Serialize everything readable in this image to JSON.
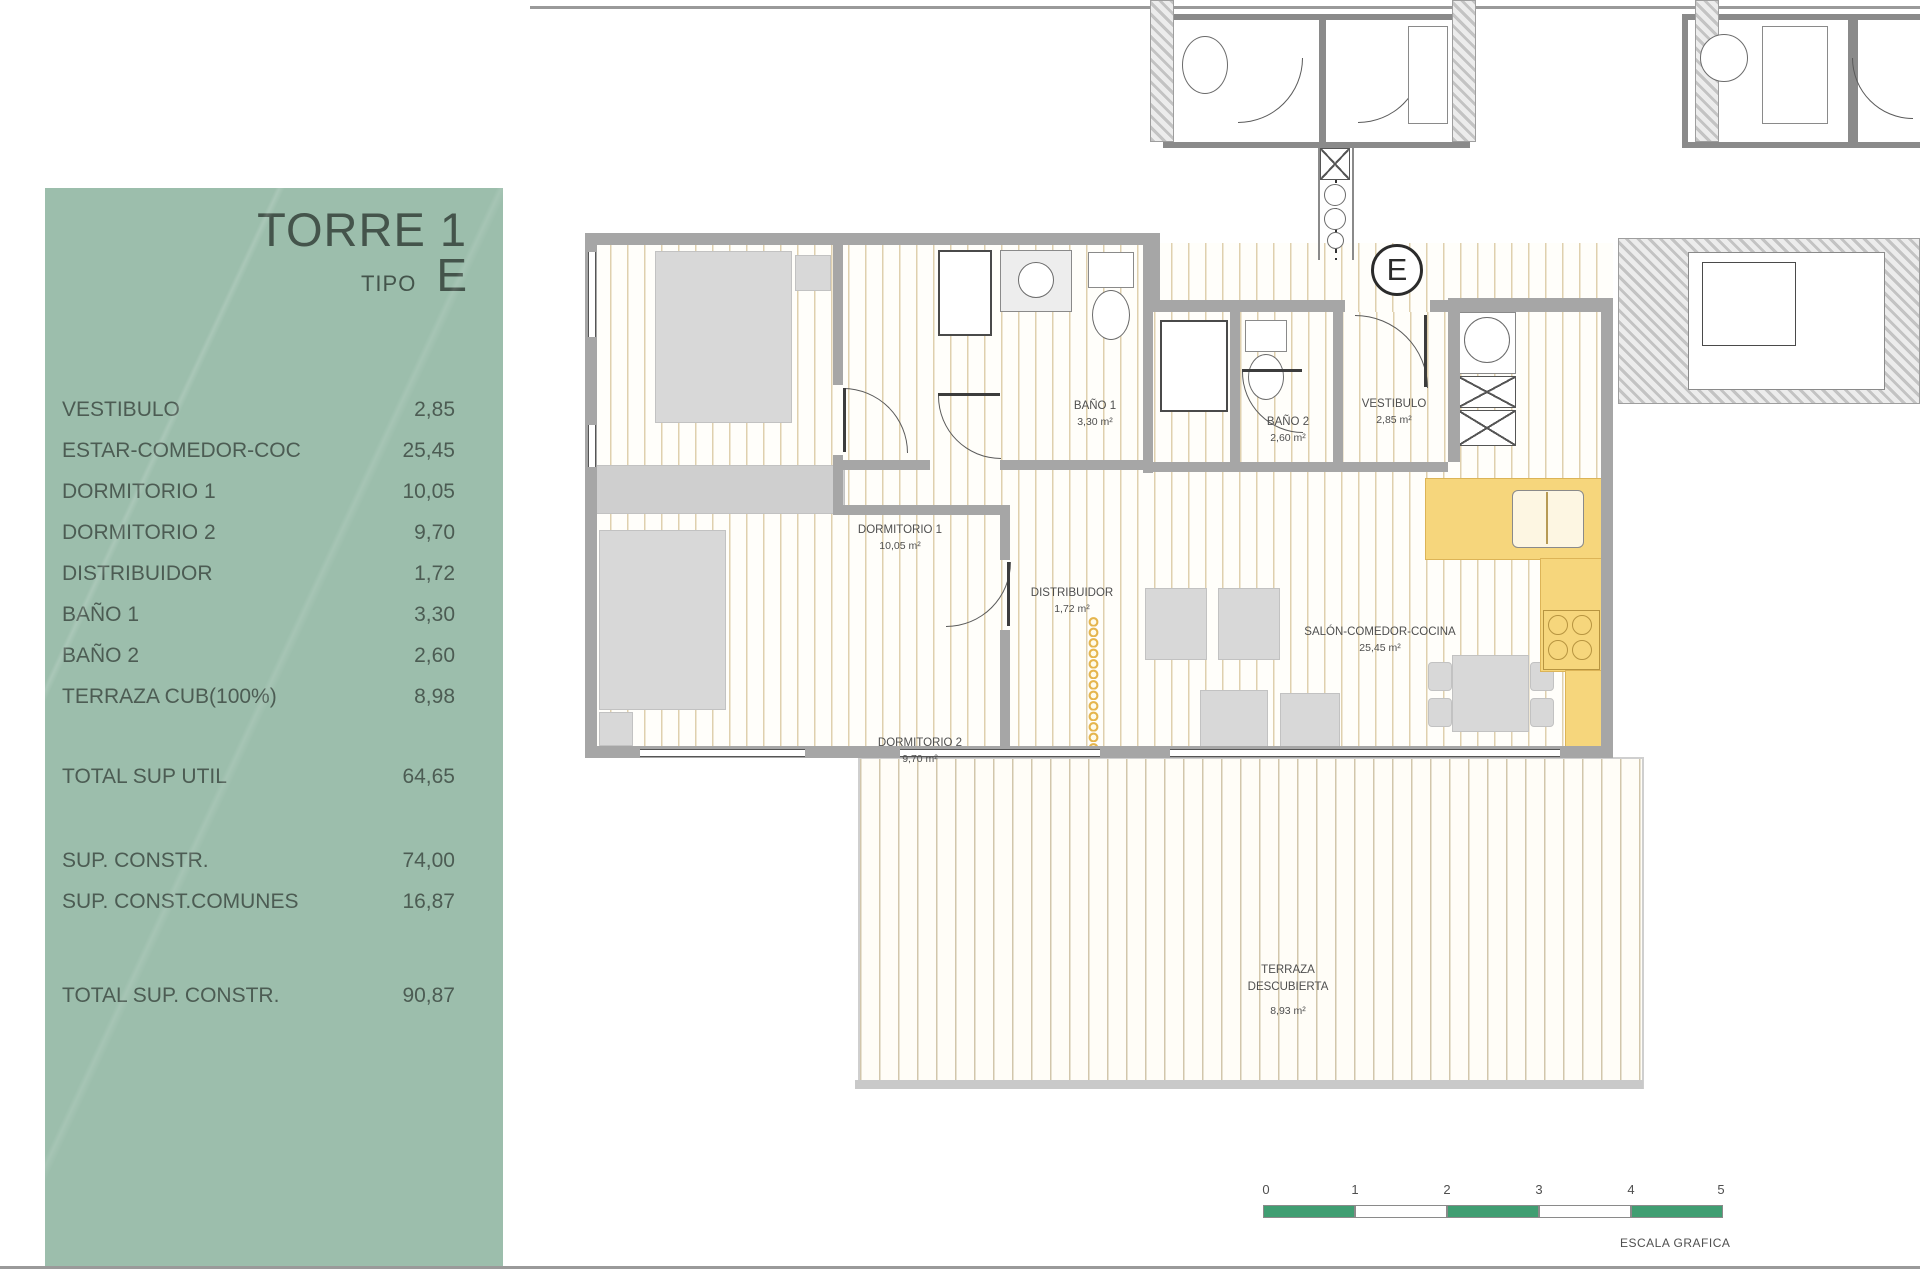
{
  "colors": {
    "panel_green": "#9cbeac",
    "panel_text": "#4c5c53",
    "wall_grey": "#a6a6a6",
    "floor_stripe": "#dfd0ae",
    "kitchen_yellow": "#f6d67c",
    "scale_green": "#409e72"
  },
  "panel": {
    "title": "TORRE 1",
    "tipo_label": "TIPO",
    "tipo_value": "E",
    "rows": [
      {
        "label": "VESTIBULO",
        "value": "2,85"
      },
      {
        "label": "ESTAR-COMEDOR-COC",
        "value": "25,45"
      },
      {
        "label": "DORMITORIO 1",
        "value": "10,05"
      },
      {
        "label": "DORMITORIO 2",
        "value": "9,70"
      },
      {
        "label": "DISTRIBUIDOR",
        "value": "1,72"
      },
      {
        "label": "BAÑO 1",
        "value": "3,30"
      },
      {
        "label": "BAÑO 2",
        "value": "2,60"
      },
      {
        "label": "TERRAZA CUB(100%)",
        "value": "8,98"
      }
    ],
    "total_util": {
      "label": "TOTAL SUP UTIL",
      "value": "64,65"
    },
    "sup_constr": {
      "label": "SUP. CONSTR.",
      "value": "74,00"
    },
    "sup_comunes": {
      "label": "SUP. CONST.COMUNES",
      "value": "16,87"
    },
    "total_constr": {
      "label": "TOTAL SUP. CONSTR.",
      "value": "90,87"
    }
  },
  "plan": {
    "unit_letter": "E",
    "rooms": [
      {
        "name": "BAÑO 1",
        "area": "3,30 m²"
      },
      {
        "name": "BAÑO 2",
        "area": "2,60 m²"
      },
      {
        "name": "VESTIBULO",
        "area": "2,85 m²"
      },
      {
        "name": "DORMITORIO 1",
        "area": "10,05 m²"
      },
      {
        "name": "DISTRIBUIDOR",
        "area": "1,72 m²"
      },
      {
        "name": "SALÓN-COMEDOR-COCINA",
        "area": "25,45 m²"
      },
      {
        "name": "DORMITORIO 2",
        "area": "9,70 m²"
      }
    ],
    "terrace": {
      "line1": "TERRAZA",
      "line2": "DESCUBIERTA",
      "area": "8,93 m²"
    }
  },
  "scale": {
    "ticks": [
      "0",
      "1",
      "2",
      "3",
      "4",
      "5"
    ],
    "caption": "ESCALA GRAFICA"
  }
}
